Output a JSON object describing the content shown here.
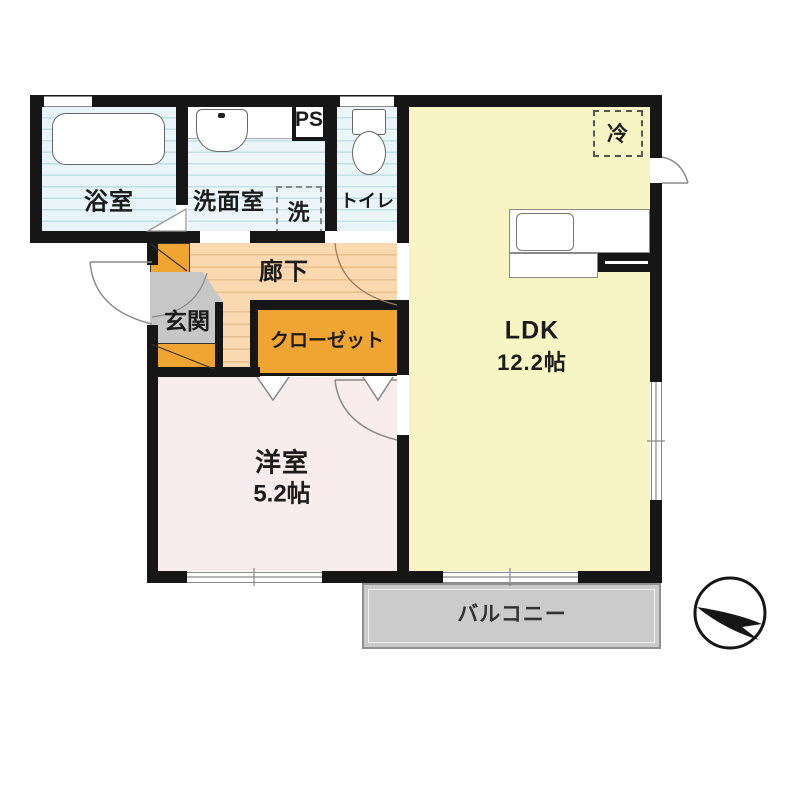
{
  "rooms": {
    "bathroom": {
      "label": "浴室"
    },
    "washroom": {
      "label": "洗面室"
    },
    "laundry": {
      "label": "洗"
    },
    "toilet": {
      "label": "トイレ"
    },
    "pipe_space": {
      "label": "PS"
    },
    "refrigerator": {
      "label": "冷"
    },
    "ldk": {
      "label": "LDK",
      "size": "12.2帖"
    },
    "hallway": {
      "label": "廊下"
    },
    "entrance": {
      "label": "玄関"
    },
    "closet": {
      "label": "クローゼット"
    },
    "western_room": {
      "label": "洋室",
      "size": "5.2帖"
    },
    "balcony": {
      "label": "バルコニー"
    }
  },
  "colors": {
    "wall": "#161616",
    "bathroom": "#d5ebf0",
    "washroom": "#dceef3",
    "toilet": "#d9edf2",
    "ldk": "#f8f5c5",
    "hallway": "#fbd9b0",
    "closet": "#f0a431",
    "entrance_floor": "#c7c7c7",
    "western_room": "#f8ecec",
    "balcony": "#cbcbcb"
  }
}
